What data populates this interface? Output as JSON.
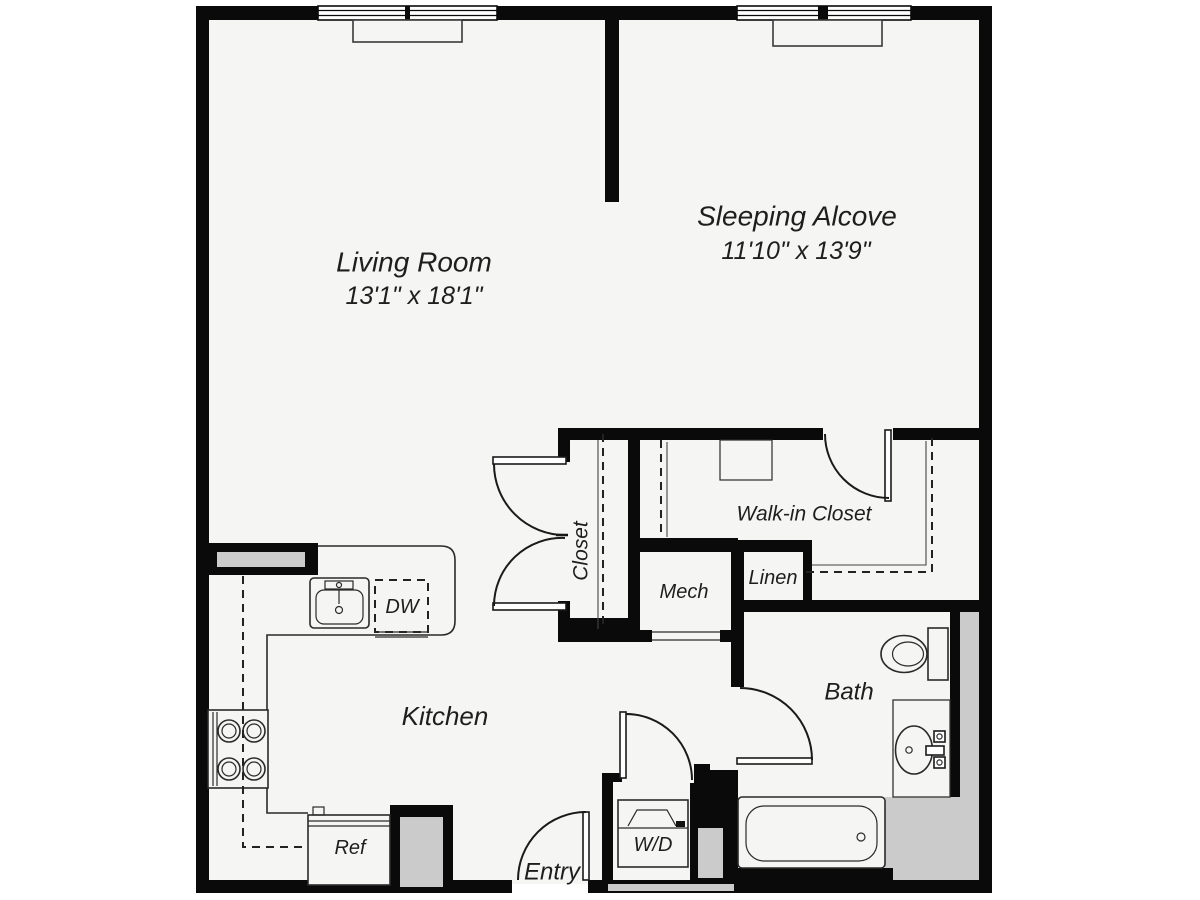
{
  "plan": {
    "rooms": {
      "living_room": {
        "name": "Living Room",
        "dimensions": "13'1\" x 18'1\""
      },
      "sleeping_alcove": {
        "name": "Sleeping Alcove",
        "dimensions": "11'10\" x 13'9\""
      },
      "walk_in_closet": {
        "name": "Walk-in Closet"
      },
      "closet": {
        "name": "Closet"
      },
      "mech": {
        "name": "Mech"
      },
      "linen": {
        "name": "Linen"
      },
      "bath": {
        "name": "Bath"
      },
      "kitchen": {
        "name": "Kitchen"
      },
      "entry": {
        "name": "Entry"
      }
    },
    "appliances": {
      "dishwasher_label": "DW",
      "refrigerator_label": "Ref",
      "washer_dryer_label": "W/D"
    },
    "colors": {
      "wall": "#0a0a0a",
      "floor": "#f5f5f4",
      "shading": "#cbcbcb",
      "text": "#1e1e1e",
      "background": "#ffffff"
    }
  }
}
